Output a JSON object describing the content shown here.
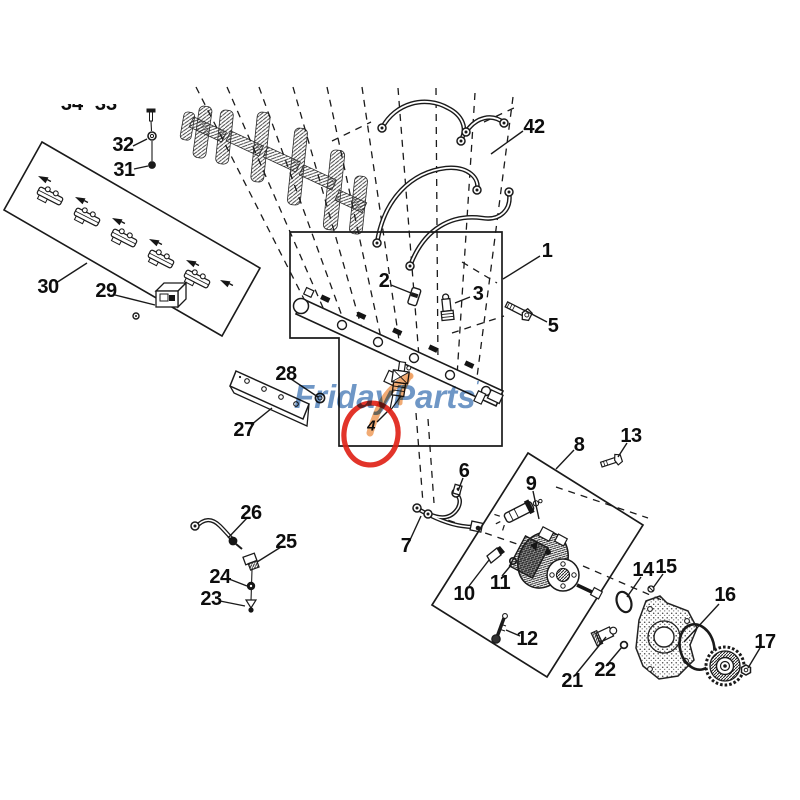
{
  "watermark": {
    "text": "FridayParts",
    "mark": "'",
    "color": "#648FC2",
    "swoosh_color": "#F0A265"
  },
  "highlight": {
    "highlighted_part": "4",
    "circle_color": "#E02318"
  },
  "diagram": {
    "type": "exploded-parts-diagram",
    "line_color": "#1a1a1a",
    "background": "#ffffff"
  },
  "callouts": [
    {
      "text": "1",
      "x": 547,
      "y": 251
    },
    {
      "text": "2",
      "x": 384,
      "y": 281
    },
    {
      "text": "3",
      "x": 478,
      "y": 294
    },
    {
      "text": "4",
      "x": 371,
      "y": 426,
      "small": true
    },
    {
      "text": "5",
      "x": 553,
      "y": 326
    },
    {
      "text": "6",
      "x": 464,
      "y": 471
    },
    {
      "text": "7",
      "x": 406,
      "y": 546
    },
    {
      "text": "8",
      "x": 579,
      "y": 445
    },
    {
      "text": "9",
      "x": 531,
      "y": 484
    },
    {
      "text": "10",
      "x": 464,
      "y": 594
    },
    {
      "text": "11",
      "x": 500,
      "y": 583
    },
    {
      "text": "12",
      "x": 527,
      "y": 639
    },
    {
      "text": "13",
      "x": 631,
      "y": 436
    },
    {
      "text": "14",
      "x": 643,
      "y": 570
    },
    {
      "text": "15",
      "x": 666,
      "y": 567
    },
    {
      "text": "16",
      "x": 725,
      "y": 595
    },
    {
      "text": "17",
      "x": 765,
      "y": 642
    },
    {
      "text": "21",
      "x": 572,
      "y": 681
    },
    {
      "text": "22",
      "x": 605,
      "y": 670
    },
    {
      "text": "23",
      "x": 211,
      "y": 599
    },
    {
      "text": "24",
      "x": 220,
      "y": 577
    },
    {
      "text": "25",
      "x": 286,
      "y": 542
    },
    {
      "text": "26",
      "x": 251,
      "y": 513
    },
    {
      "text": "27",
      "x": 244,
      "y": 430
    },
    {
      "text": "28",
      "x": 286,
      "y": 374
    },
    {
      "text": "29",
      "x": 106,
      "y": 291
    },
    {
      "text": "30",
      "x": 48,
      "y": 287
    },
    {
      "text": "31",
      "x": 124,
      "y": 170
    },
    {
      "text": "32",
      "x": 123,
      "y": 145
    },
    {
      "text": "42",
      "x": 534,
      "y": 127
    }
  ],
  "partial_labels": [
    {
      "text": "34",
      "x": 72
    },
    {
      "text": "33",
      "x": 106
    }
  ]
}
